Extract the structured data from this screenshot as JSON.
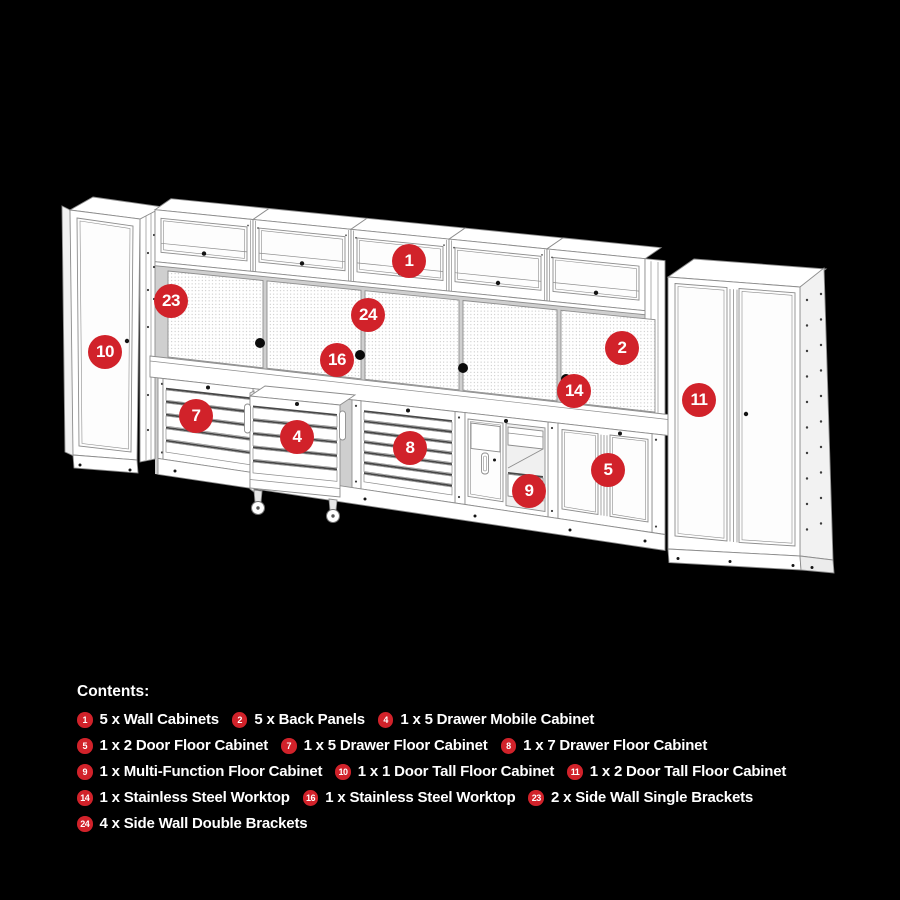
{
  "colors": {
    "background": "#000000",
    "badge_red": "#d1222a",
    "cabinet_fill": "#ffffff",
    "line_gray": "#8d8d8d"
  },
  "diagram": {
    "badges": [
      {
        "label": "1",
        "x": 409,
        "y": 261
      },
      {
        "label": "2",
        "x": 622,
        "y": 348
      },
      {
        "label": "4",
        "x": 297,
        "y": 437
      },
      {
        "label": "5",
        "x": 608,
        "y": 470
      },
      {
        "label": "7",
        "x": 196,
        "y": 416
      },
      {
        "label": "8",
        "x": 410,
        "y": 448
      },
      {
        "label": "9",
        "x": 529,
        "y": 491
      },
      {
        "label": "10",
        "x": 105,
        "y": 352
      },
      {
        "label": "11",
        "x": 699,
        "y": 400
      },
      {
        "label": "14",
        "x": 574,
        "y": 391
      },
      {
        "label": "16",
        "x": 337,
        "y": 360
      },
      {
        "label": "23",
        "x": 171,
        "y": 301
      },
      {
        "label": "24",
        "x": 368,
        "y": 315
      }
    ]
  },
  "contents": {
    "heading": "Contents:",
    "rows": [
      [
        {
          "badge": "1",
          "text": "5 x Wall Cabinets"
        },
        {
          "badge": "2",
          "text": "5 x Back Panels"
        },
        {
          "badge": "4",
          "text": "1 x 5 Drawer Mobile Cabinet"
        }
      ],
      [
        {
          "badge": "5",
          "text": "1 x 2 Door Floor Cabinet"
        },
        {
          "badge": "7",
          "text": "1 x 5 Drawer Floor Cabinet"
        },
        {
          "badge": "8",
          "text": "1 x 7 Drawer Floor Cabinet"
        }
      ],
      [
        {
          "badge": "9",
          "text": "1 x Multi-Function Floor Cabinet"
        },
        {
          "badge": "10",
          "text": "1 x 1 Door Tall Floor Cabinet"
        },
        {
          "badge": "11",
          "text": "1 x 2 Door Tall Floor Cabinet"
        }
      ],
      [
        {
          "badge": "14",
          "text": "1 x Stainless Steel Worktop"
        },
        {
          "badge": "16",
          "text": "1 x Stainless Steel Worktop"
        },
        {
          "badge": "23",
          "text": "2 x Side Wall Single Brackets"
        }
      ],
      [
        {
          "badge": "24",
          "text": "4 x Side Wall Double Brackets"
        }
      ]
    ]
  }
}
